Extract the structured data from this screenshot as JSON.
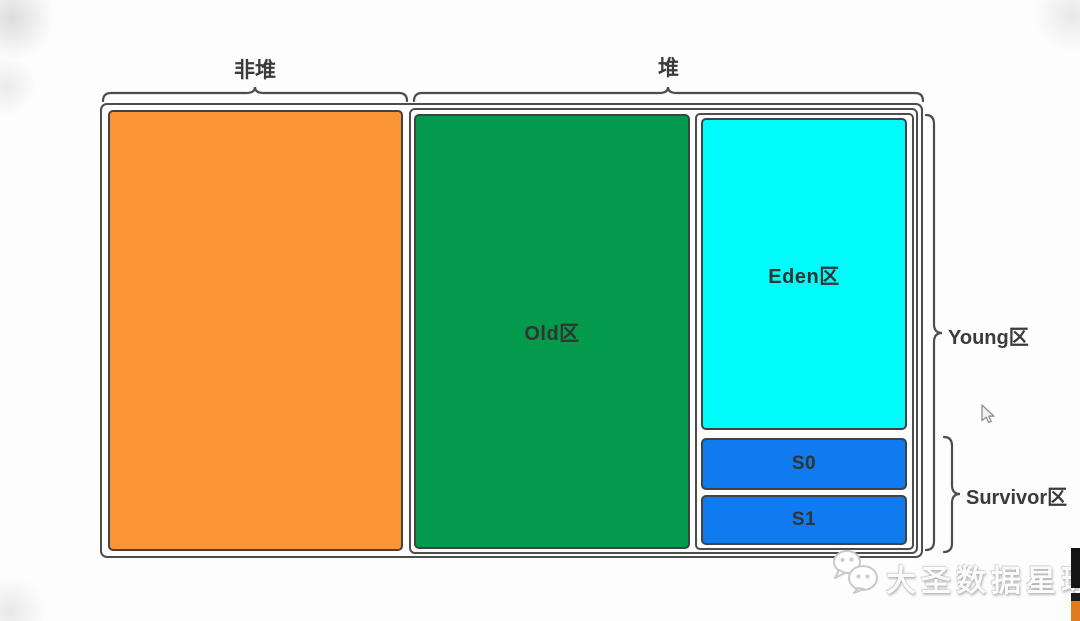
{
  "diagram": {
    "non_heap": {
      "label": "非堆",
      "color": "#F99537"
    },
    "heap": {
      "label": "堆",
      "old": {
        "label": "Old区",
        "color": "#049A4C"
      },
      "young": {
        "label": "Young区",
        "eden": {
          "label": "Eden区",
          "color": "#00FBFB"
        },
        "survivor": {
          "label": "Survivor区",
          "s0": {
            "label": "S0",
            "color": "#107BEF"
          },
          "s1": {
            "label": "S1",
            "color": "#107BEF"
          }
        }
      }
    },
    "style": {
      "border_color": "#4D4D4D",
      "text_color": "#3B3B3B",
      "background": "#FDFDFD"
    },
    "watermark": {
      "icon": "wechat-icon",
      "text": "大圣数据星球"
    }
  }
}
